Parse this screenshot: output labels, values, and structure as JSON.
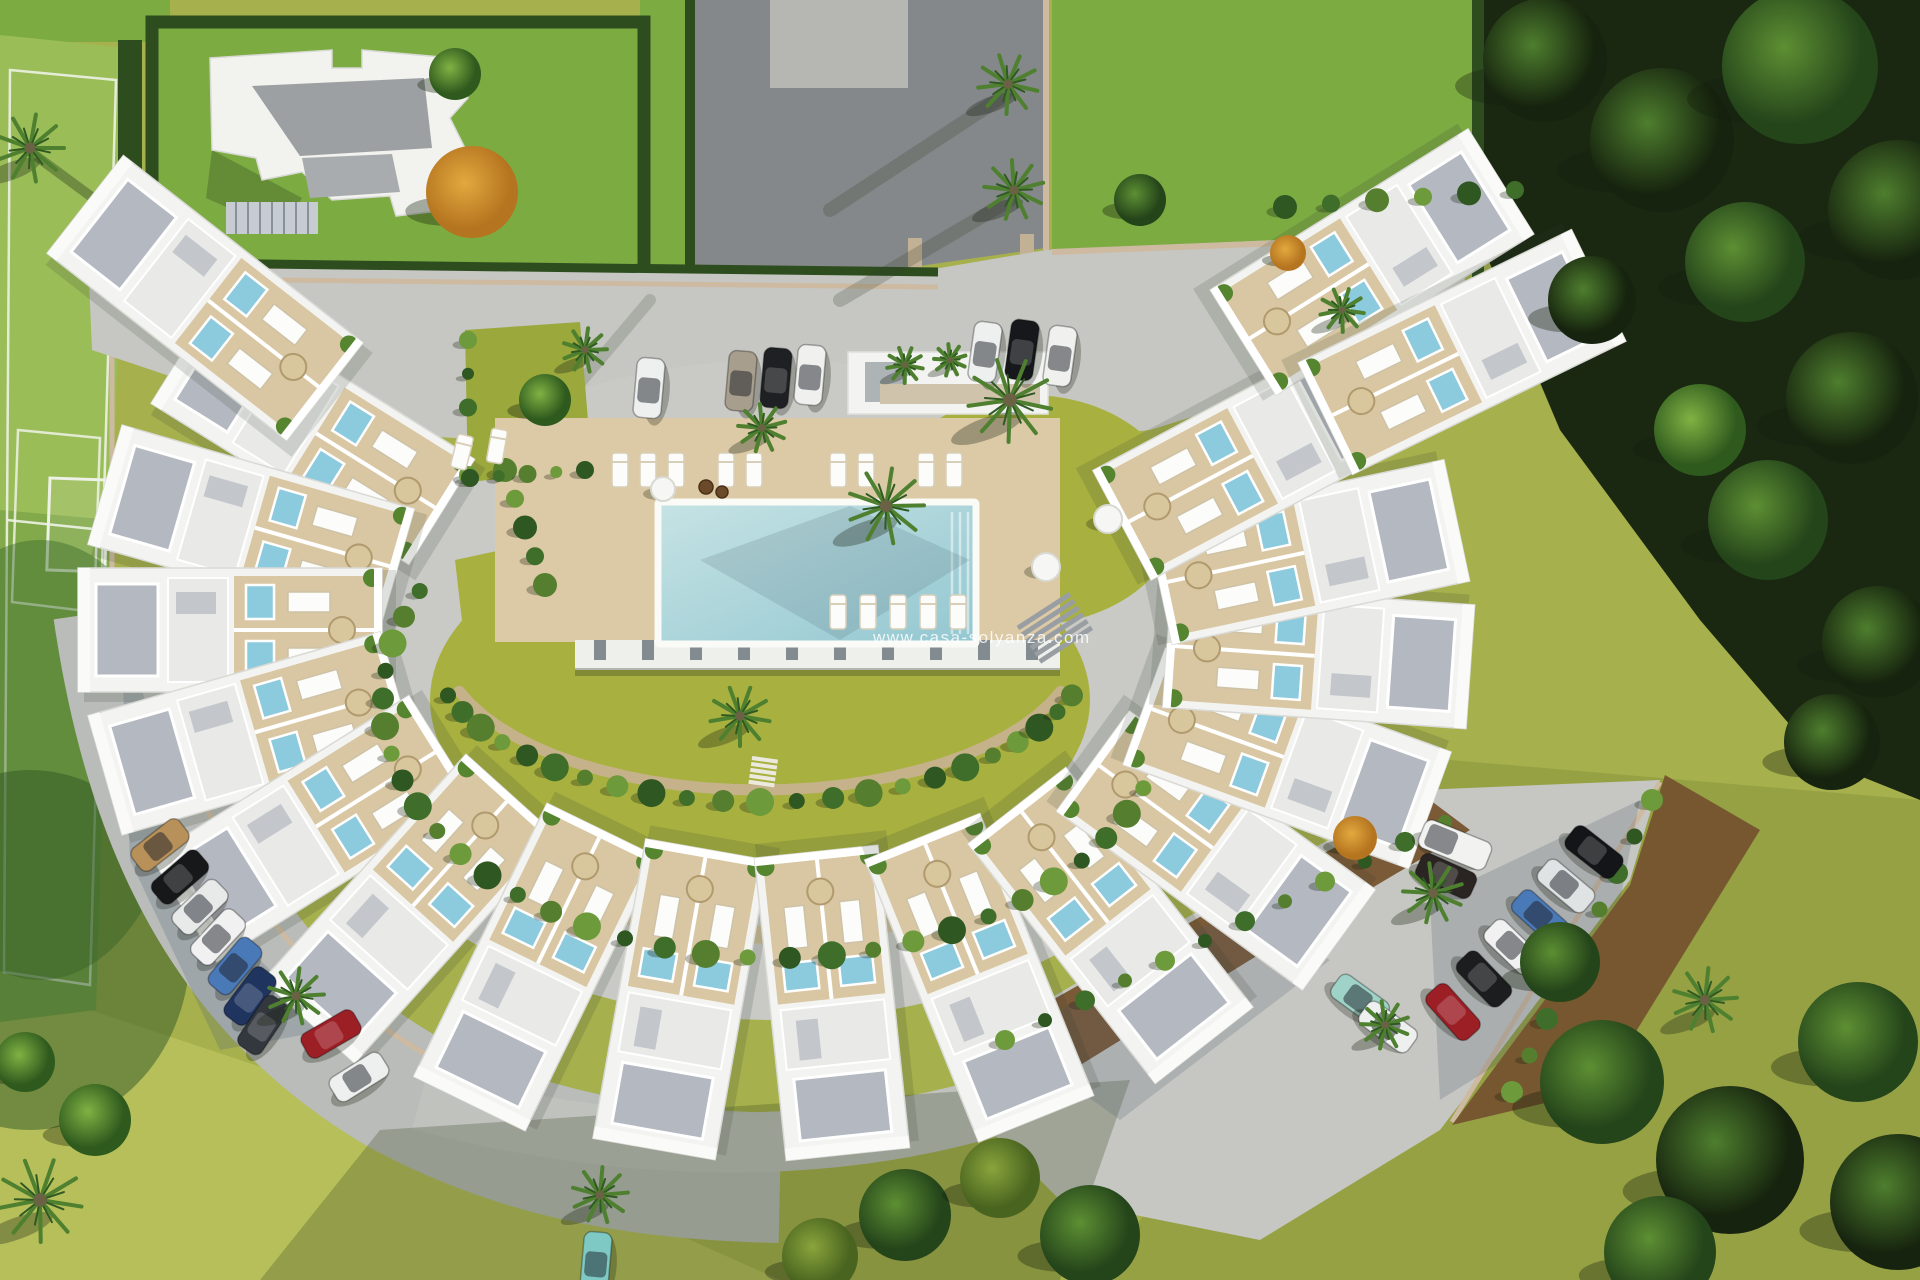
{
  "watermark": {
    "text": "www.casa-solyanza.com"
  },
  "palette": {
    "lawn_olive": "#a6b04c",
    "lawn_bright": "#7cab42",
    "lawn_light": "#b6bf5a",
    "pitch_upper": "#9abd58",
    "pitch_lower": "#82a94a",
    "pitch_line": "#eef2e6",
    "hedge": "#2e4d1f",
    "woodland": "#1a2711",
    "road_asphalt": "#85888a",
    "paving": "#c6c7c2",
    "paving_blue_shadow": "rgba(80,95,120,0.24)",
    "curb": "#cdbaa1",
    "mulch": "#7b5a37",
    "garden_soil": "#77572f",
    "building_white": "#f3f4f1",
    "roof_gravel": "#b4b8c0",
    "deck_beige": "#dcc9a5",
    "terrace_wood": "#d9c7a3",
    "ring_path": "#cbbd98",
    "inner_path": "#c6b28a",
    "pool_water_light": "#c6e3e4",
    "pool_water_deep": "#93c7d1",
    "jacuzzi": "#8ccadd",
    "lounger": "#fcfcfa",
    "parasol": "#d8c69c",
    "palm_frond": "#4e8030",
    "palm_frond_dark": "#2f5a22",
    "shrub_tones": [
      "#3f6e2a",
      "#557f2f",
      "#6d9a3a",
      "#2f5722"
    ],
    "tree_light_center": "#7fb243",
    "tree_light_edge": "#2f5a1e",
    "tree_mid_center": "#5d8f33",
    "tree_mid_edge": "#24441a",
    "tree_dark_center": "#4e7e2e",
    "tree_dark_edge": "#16230e",
    "tree_olive_center": "#8aa43c",
    "tree_olive_edge": "#49641f",
    "tree_orange_center": "#e2a93f",
    "tree_orange_edge": "#b5741f"
  },
  "pool": {
    "x": 658,
    "y": 502,
    "w": 318,
    "h": 142
  },
  "units": {
    "center": {
      "x": 775,
      "y": 630
    },
    "rx": 545,
    "ry": 375,
    "w": 124,
    "d": 304,
    "thetas": [
      212,
      196,
      180,
      164,
      148,
      132,
      116,
      100,
      84,
      68,
      52,
      36,
      20,
      4,
      348,
      332
    ],
    "extra": [
      {
        "x": 205,
        "y": 298,
        "rot": -52
      },
      {
        "x": 1372,
        "y": 262,
        "rot": 58
      },
      {
        "x": 1462,
        "y": 352,
        "rot": 64
      }
    ]
  },
  "cars": [
    {
      "x": 160,
      "y": 845,
      "rot": -38,
      "color": "#b8915a"
    },
    {
      "x": 180,
      "y": 877,
      "rot": -41,
      "color": "#17181a"
    },
    {
      "x": 200,
      "y": 907,
      "rot": -44,
      "color": "#e8eaea"
    },
    {
      "x": 218,
      "y": 937,
      "rot": -47,
      "color": "#f0f1f0"
    },
    {
      "x": 235,
      "y": 966,
      "rot": -50,
      "color": "#4a79b8"
    },
    {
      "x": 250,
      "y": 996,
      "rot": -53,
      "color": "#1f3560"
    },
    {
      "x": 263,
      "y": 1025,
      "rot": -56,
      "color": "#33383f"
    },
    {
      "x": 331,
      "y": 1034,
      "rot": -30,
      "color": "#9c1f26"
    },
    {
      "x": 359,
      "y": 1077,
      "rot": -32,
      "color": "#eef0ef"
    },
    {
      "x": 649,
      "y": 388,
      "rot": -85,
      "color": "#eef0ef"
    },
    {
      "x": 741,
      "y": 381,
      "rot": -85,
      "color": "#a89e8e"
    },
    {
      "x": 776,
      "y": 378,
      "rot": -85,
      "color": "#1f2023"
    },
    {
      "x": 810,
      "y": 375,
      "rot": -85,
      "color": "#f0f1ef"
    },
    {
      "x": 985,
      "y": 352,
      "rot": -82,
      "color": "#eef0ef"
    },
    {
      "x": 1022,
      "y": 350,
      "rot": -82,
      "color": "#17181b"
    },
    {
      "x": 1060,
      "y": 356,
      "rot": -82,
      "color": "#f0f1ee"
    },
    {
      "x": 1594,
      "y": 852,
      "rot": 38,
      "color": "#141518"
    },
    {
      "x": 1566,
      "y": 886,
      "rot": 40,
      "color": "#dfe3e4"
    },
    {
      "x": 1540,
      "y": 917,
      "rot": 42,
      "color": "#4a79b8"
    },
    {
      "x": 1512,
      "y": 947,
      "rot": 44,
      "color": "#f0f1f0"
    },
    {
      "x": 1484,
      "y": 979,
      "rot": 46,
      "color": "#1b1d1f"
    },
    {
      "x": 1453,
      "y": 1012,
      "rot": 48,
      "color": "#9c1f26"
    },
    {
      "x": 1455,
      "y": 845,
      "rot": 22,
      "color": "#f2f3f1",
      "van": true
    },
    {
      "x": 1446,
      "y": 876,
      "rot": 24,
      "color": "#2a2522"
    },
    {
      "x": 1360,
      "y": 1000,
      "rot": 36,
      "color": "#9fd3c7"
    },
    {
      "x": 1388,
      "y": 1027,
      "rot": 36,
      "color": "#eef0ef"
    },
    {
      "x": 596,
      "y": 1262,
      "rot": -85,
      "color": "#7fc9c4"
    }
  ],
  "palms": [
    {
      "x": 30,
      "y": 148,
      "r": 34
    },
    {
      "x": 1008,
      "y": 84,
      "r": 30
    },
    {
      "x": 1014,
      "y": 190,
      "r": 30
    },
    {
      "x": 886,
      "y": 506,
      "r": 38
    },
    {
      "x": 1010,
      "y": 400,
      "r": 42
    },
    {
      "x": 762,
      "y": 428,
      "r": 24
    },
    {
      "x": 585,
      "y": 350,
      "r": 22
    },
    {
      "x": 905,
      "y": 365,
      "r": 18
    },
    {
      "x": 950,
      "y": 360,
      "r": 16
    },
    {
      "x": 296,
      "y": 996,
      "r": 28
    },
    {
      "x": 740,
      "y": 716,
      "r": 30
    },
    {
      "x": 1433,
      "y": 893,
      "r": 30
    },
    {
      "x": 1705,
      "y": 1000,
      "r": 32
    },
    {
      "x": 40,
      "y": 1200,
      "r": 42
    },
    {
      "x": 1385,
      "y": 1025,
      "r": 24
    },
    {
      "x": 600,
      "y": 1195,
      "r": 28
    },
    {
      "x": 1342,
      "y": 310,
      "r": 22
    }
  ],
  "trees": [
    {
      "x": 1545,
      "y": 60,
      "r": 62,
      "t": "dark"
    },
    {
      "x": 1662,
      "y": 140,
      "r": 72,
      "t": "dark"
    },
    {
      "x": 1800,
      "y": 66,
      "r": 78,
      "t": "mid"
    },
    {
      "x": 1898,
      "y": 210,
      "r": 70,
      "t": "dark"
    },
    {
      "x": 1745,
      "y": 262,
      "r": 60,
      "t": "mid"
    },
    {
      "x": 1852,
      "y": 398,
      "r": 66,
      "t": "dark"
    },
    {
      "x": 1768,
      "y": 520,
      "r": 60,
      "t": "mid"
    },
    {
      "x": 1878,
      "y": 642,
      "r": 56,
      "t": "dark"
    },
    {
      "x": 1700,
      "y": 430,
      "r": 46,
      "t": "light"
    },
    {
      "x": 1592,
      "y": 300,
      "r": 44,
      "t": "dark"
    },
    {
      "x": 1832,
      "y": 742,
      "r": 48,
      "t": "dark"
    },
    {
      "x": 1602,
      "y": 1082,
      "r": 62,
      "t": "mid"
    },
    {
      "x": 1730,
      "y": 1160,
      "r": 74,
      "t": "dark"
    },
    {
      "x": 1858,
      "y": 1042,
      "r": 60,
      "t": "mid"
    },
    {
      "x": 1898,
      "y": 1202,
      "r": 68,
      "t": "dark"
    },
    {
      "x": 1660,
      "y": 1252,
      "r": 56,
      "t": "mid"
    },
    {
      "x": 1560,
      "y": 962,
      "r": 40,
      "t": "mid"
    },
    {
      "x": 905,
      "y": 1215,
      "r": 46,
      "t": "mid"
    },
    {
      "x": 1000,
      "y": 1178,
      "r": 40,
      "t": "olive"
    },
    {
      "x": 1090,
      "y": 1235,
      "r": 50,
      "t": "mid"
    },
    {
      "x": 820,
      "y": 1256,
      "r": 38,
      "t": "olive"
    },
    {
      "x": 95,
      "y": 1120,
      "r": 36,
      "t": "light"
    },
    {
      "x": 25,
      "y": 1062,
      "r": 30,
      "t": "light"
    },
    {
      "x": 1140,
      "y": 200,
      "r": 26,
      "t": "mid"
    },
    {
      "x": 455,
      "y": 74,
      "r": 26,
      "t": "light"
    },
    {
      "x": 545,
      "y": 400,
      "r": 26,
      "t": "light"
    },
    {
      "x": 472,
      "y": 192,
      "r": 46,
      "t": "orange"
    },
    {
      "x": 1355,
      "y": 838,
      "r": 22,
      "t": "orange"
    },
    {
      "x": 1288,
      "y": 253,
      "r": 18,
      "t": "orange"
    }
  ],
  "shrub_rings": [
    {
      "cx": 775,
      "cy": 700,
      "rx": 392,
      "ry": 258,
      "a0": 205,
      "a1": 20,
      "n": 30
    },
    {
      "cx": 760,
      "cy": 640,
      "rx": 332,
      "ry": 162,
      "a0": 160,
      "a1": 20,
      "n": 22
    }
  ],
  "shrub_strips": [
    {
      "x1": 1005,
      "y1": 1040,
      "x2": 1445,
      "y2": 822,
      "n": 12,
      "r": 10
    },
    {
      "x1": 1652,
      "y1": 800,
      "x2": 1512,
      "y2": 1092,
      "n": 9,
      "r": 11
    },
    {
      "x1": 1285,
      "y1": 207,
      "x2": 1515,
      "y2": 190,
      "n": 6,
      "r": 12
    },
    {
      "x1": 505,
      "y1": 470,
      "x2": 545,
      "y2": 585,
      "n": 5,
      "r": 12
    },
    {
      "x1": 468,
      "y1": 340,
      "x2": 468,
      "y2": 475,
      "n": 5,
      "r": 9
    },
    {
      "x1": 470,
      "y1": 478,
      "x2": 585,
      "y2": 470,
      "n": 5,
      "r": 9
    }
  ],
  "loungers": {
    "deck_top": {
      "y": 470,
      "xs": [
        620,
        648,
        676,
        726,
        754,
        838,
        866,
        926,
        954
      ]
    },
    "deck_side": {
      "y": 612,
      "xs": [
        838,
        868,
        898,
        928,
        958
      ]
    },
    "west_pair": [
      {
        "x": 462,
        "y": 452,
        "rot": 14
      },
      {
        "x": 497,
        "y": 446,
        "rot": 10
      }
    ]
  },
  "tables": [
    {
      "x": 663,
      "y": 489,
      "r": 12
    },
    {
      "x": 1108,
      "y": 519,
      "r": 14
    },
    {
      "x": 1046,
      "y": 567,
      "r": 14
    }
  ],
  "chairs": [
    {
      "x": 706,
      "y": 487,
      "r": 7
    },
    {
      "x": 722,
      "y": 492,
      "r": 6
    }
  ]
}
